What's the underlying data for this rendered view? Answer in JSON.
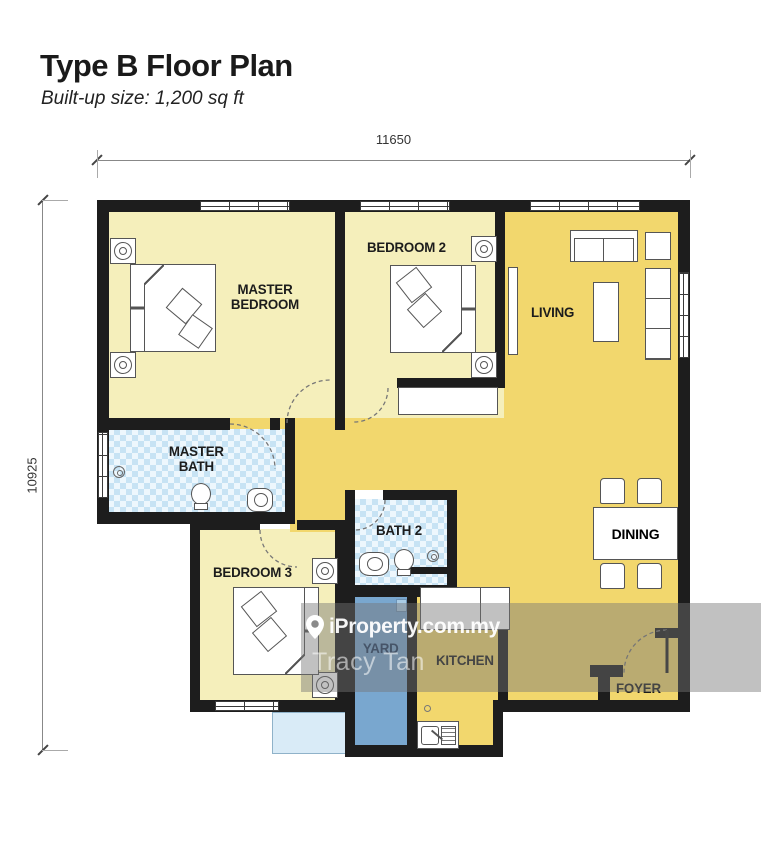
{
  "header": {
    "title": "Type B Floor Plan",
    "subtitle": "Built-up size: 1,200 sq ft"
  },
  "dimensions": {
    "top": "11650",
    "left": "10925"
  },
  "rooms": [
    {
      "id": "master-bedroom",
      "label": "MASTER BEDROOM"
    },
    {
      "id": "bedroom-2",
      "label": "BEDROOM 2"
    },
    {
      "id": "living",
      "label": "LIVING"
    },
    {
      "id": "master-bath",
      "label": "MASTER BATH"
    },
    {
      "id": "dining",
      "label": "DINING"
    },
    {
      "id": "bedroom-3",
      "label": "BEDROOM 3"
    },
    {
      "id": "bath-2",
      "label": "BATH 2"
    },
    {
      "id": "yard",
      "label": "YARD"
    },
    {
      "id": "kitchen",
      "label": "KITCHEN"
    },
    {
      "id": "foyer",
      "label": "FOYER"
    }
  ],
  "watermark": {
    "brand": "iProperty.com.my",
    "agent": "Tracy Tan"
  },
  "colors": {
    "room_pale_yellow": "#F5EFBB",
    "room_gold": "#F2D76D",
    "bath_tile": "#C7E3F4",
    "yard_blue": "#79A7CF",
    "ledge_blue": "#D9EBF7",
    "wall": "#1D1D1D",
    "yard_label_text": "#1F3A5E"
  }
}
